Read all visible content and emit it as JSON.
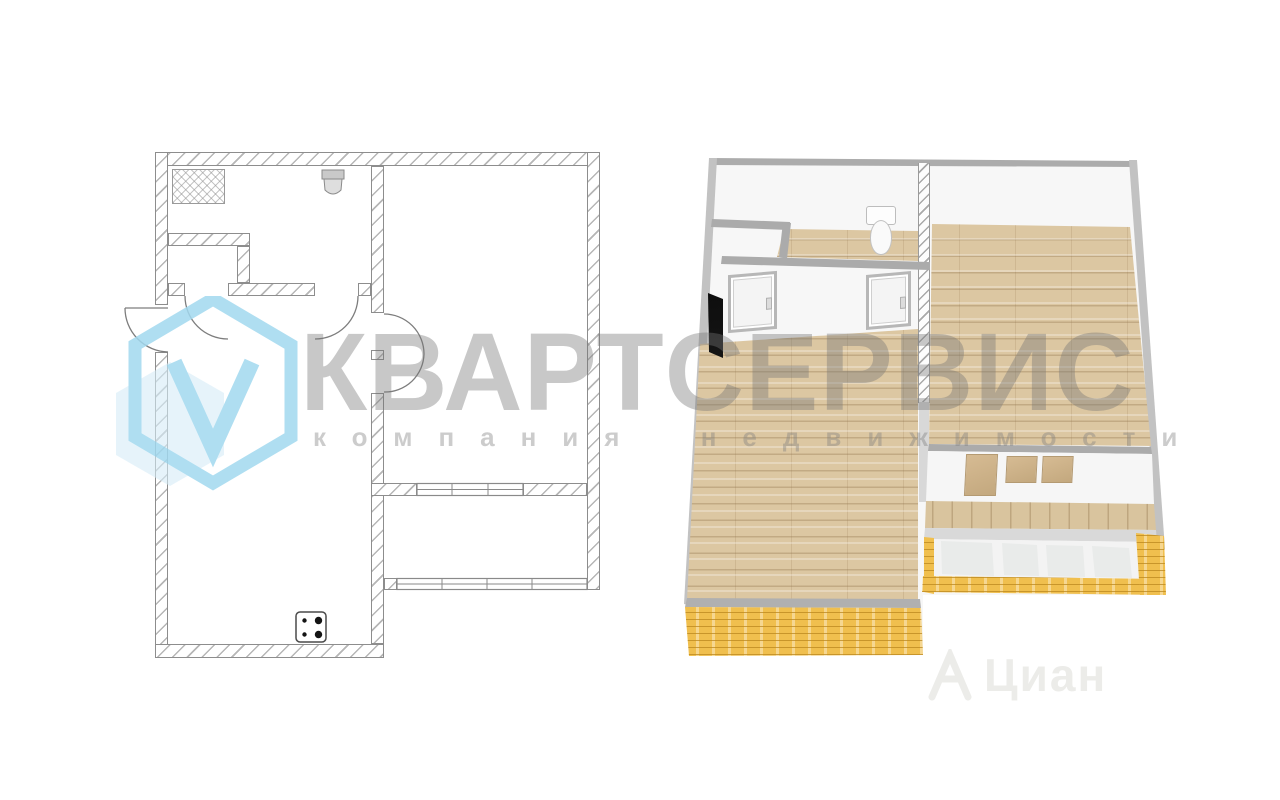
{
  "brand_watermark": {
    "title": "КВАРТСЕРВИС",
    "subtitle": "компания недвижимости",
    "logo_letter": "V",
    "logo_color": "#a2d9ef",
    "text_color": "#bdbdbd"
  },
  "corner_watermark": {
    "label": "Циан",
    "color": "#ecece9"
  },
  "palette": {
    "wall_outline": "#8d8d8d",
    "wood_floor": "#dcc7a2",
    "brick_wall": "#f0bf4e",
    "wall_white": "#f7f7f7"
  }
}
